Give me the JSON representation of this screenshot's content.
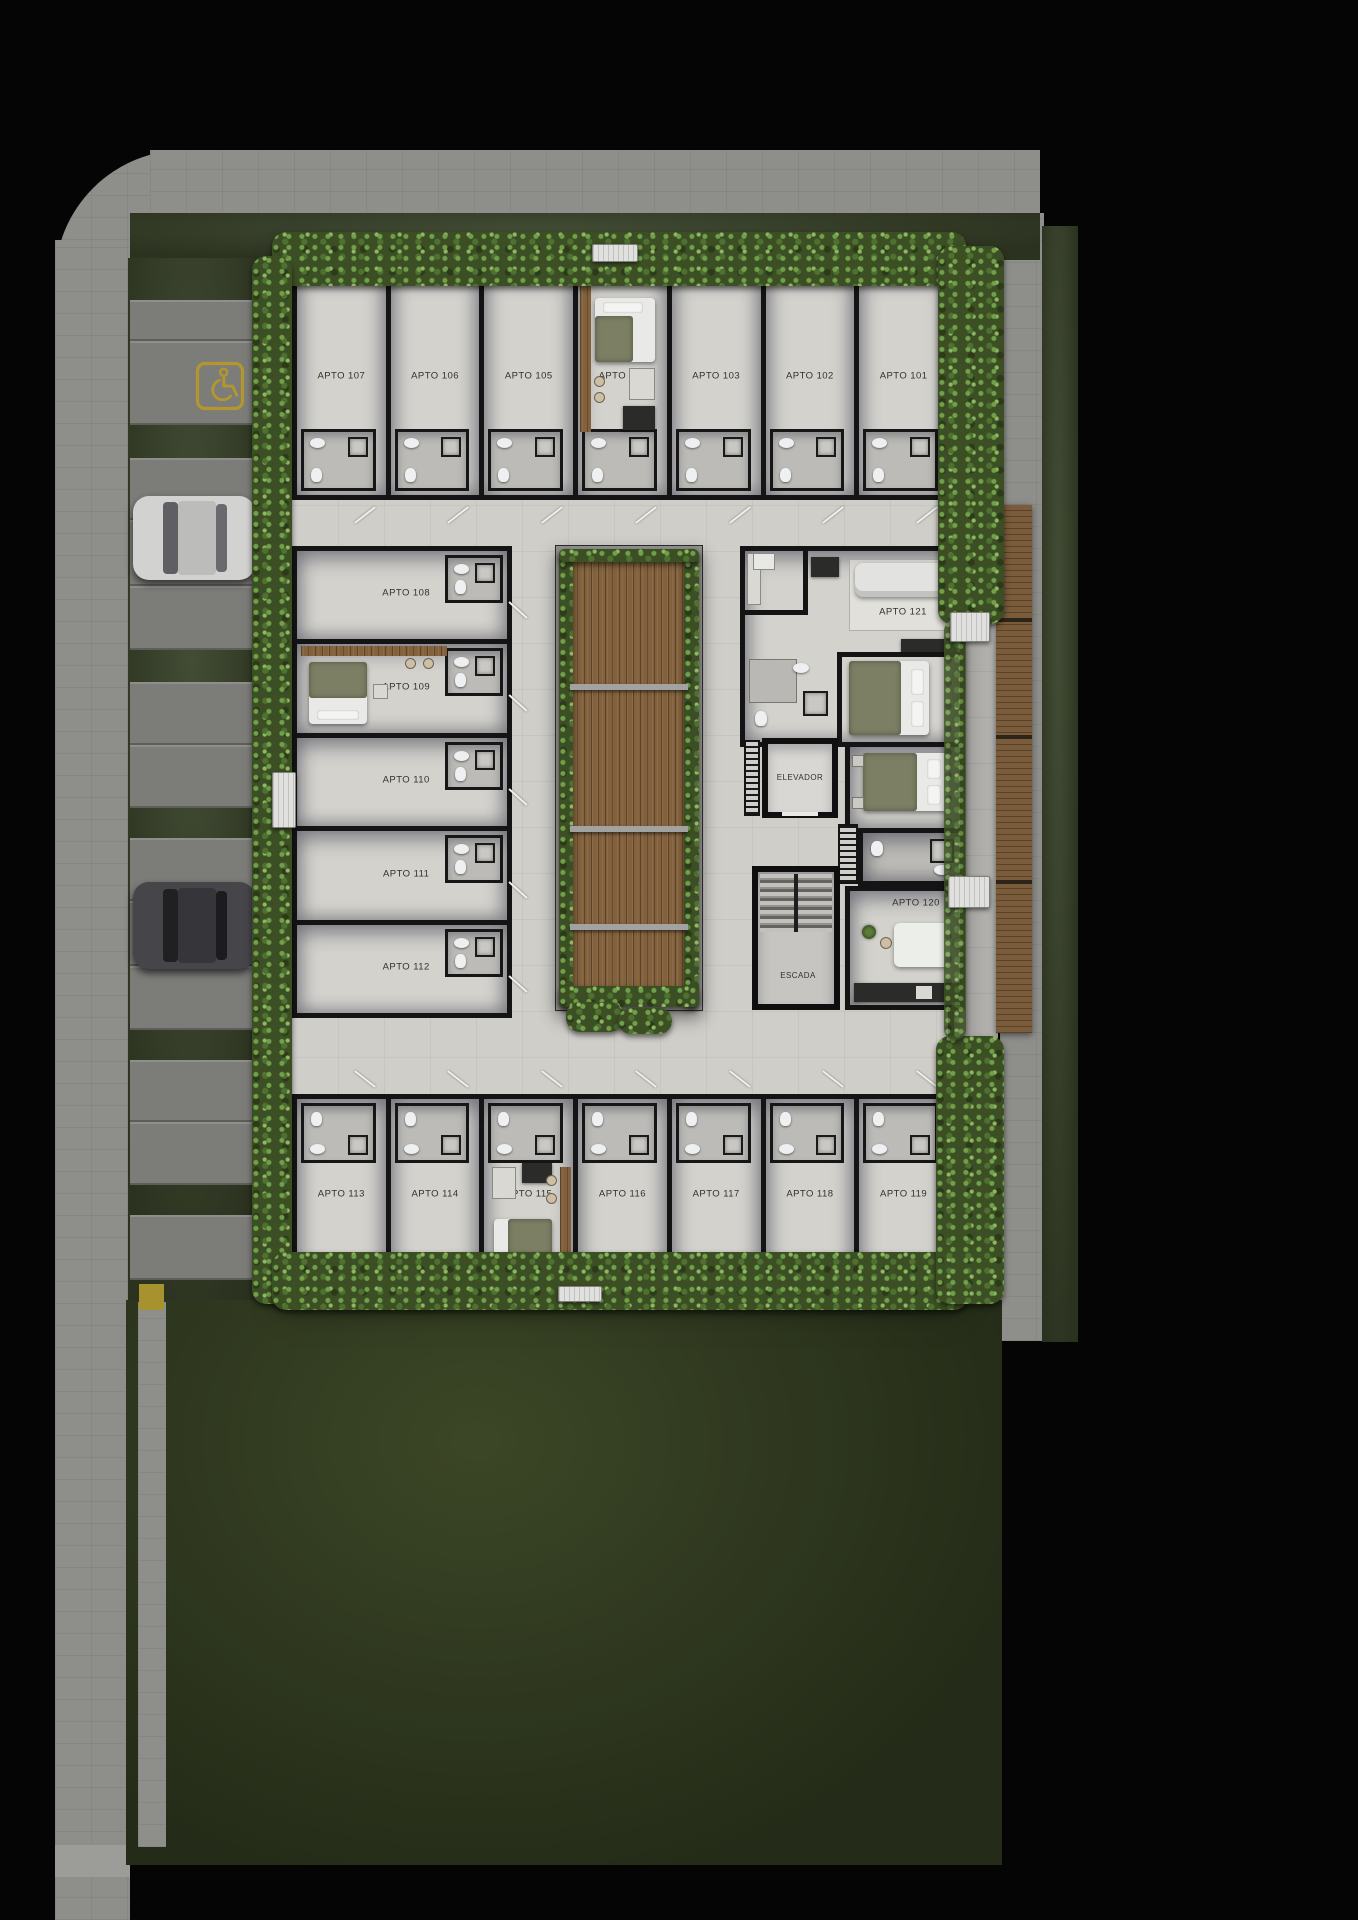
{
  "units": {
    "top_row": [
      {
        "label": "APTO 107"
      },
      {
        "label": "APTO 106"
      },
      {
        "label": "APTO 105"
      },
      {
        "label": "APTO 104",
        "furnished": true
      },
      {
        "label": "APTO 103"
      },
      {
        "label": "APTO 102"
      },
      {
        "label": "APTO 101"
      }
    ],
    "left_column": [
      {
        "label": "APTO 108"
      },
      {
        "label": "APTO 109",
        "furnished": true
      },
      {
        "label": "APTO 110"
      },
      {
        "label": "APTO 111"
      },
      {
        "label": "APTO 112"
      }
    ],
    "bottom_row": [
      {
        "label": "APTO 113"
      },
      {
        "label": "APTO 114"
      },
      {
        "label": "APTO 115",
        "furnished": true
      },
      {
        "label": "APTO 116"
      },
      {
        "label": "APTO 117"
      },
      {
        "label": "APTO 118"
      },
      {
        "label": "APTO 119"
      }
    ],
    "right_column": [
      {
        "label": "APTO 121",
        "furnished": true
      },
      {
        "label": "APTO 120",
        "furnished": true
      }
    ]
  },
  "core": {
    "elevator_label": "ELEVADOR",
    "stairs_label": "ESCADA"
  },
  "site": {
    "accessible_parking_icon": "wheelchair-symbol",
    "parked_cars": [
      "light-car",
      "dark-car"
    ]
  },
  "colors": {
    "background": "#050505",
    "sidewalk": "#8e8e8b",
    "parking_stall": "#7c7c79",
    "grass": "#39432a",
    "hedge": "#3c4f24",
    "floor": "#d3d2cd",
    "wall": "#141414",
    "deck_wood": "#82613c",
    "accent_yellow": "#b3972e"
  }
}
